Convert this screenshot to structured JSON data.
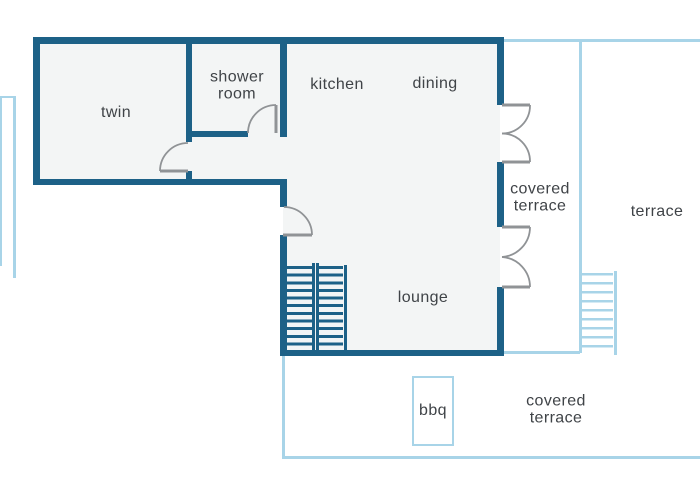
{
  "floorplan": {
    "rooms": {
      "twin": {
        "label": "twin"
      },
      "shower_room": {
        "lines": [
          "shower",
          "room"
        ]
      },
      "kitchen": {
        "label": "kitchen"
      },
      "dining": {
        "label": "dining"
      },
      "lounge": {
        "label": "lounge"
      }
    },
    "outdoor": {
      "covered_terrace_upper": {
        "lines": [
          "covered",
          "terrace"
        ]
      },
      "terrace": {
        "label": "terrace"
      },
      "bbq": {
        "label": "bbq"
      },
      "covered_terrace_lower": {
        "lines": [
          "covered",
          "terrace"
        ]
      }
    },
    "colors": {
      "wall": "#1d6187",
      "terrace_line": "#a8d4e8",
      "room_fill": "#f3f5f5",
      "label_text": "#3f4347",
      "door_stroke": "#909396"
    }
  }
}
